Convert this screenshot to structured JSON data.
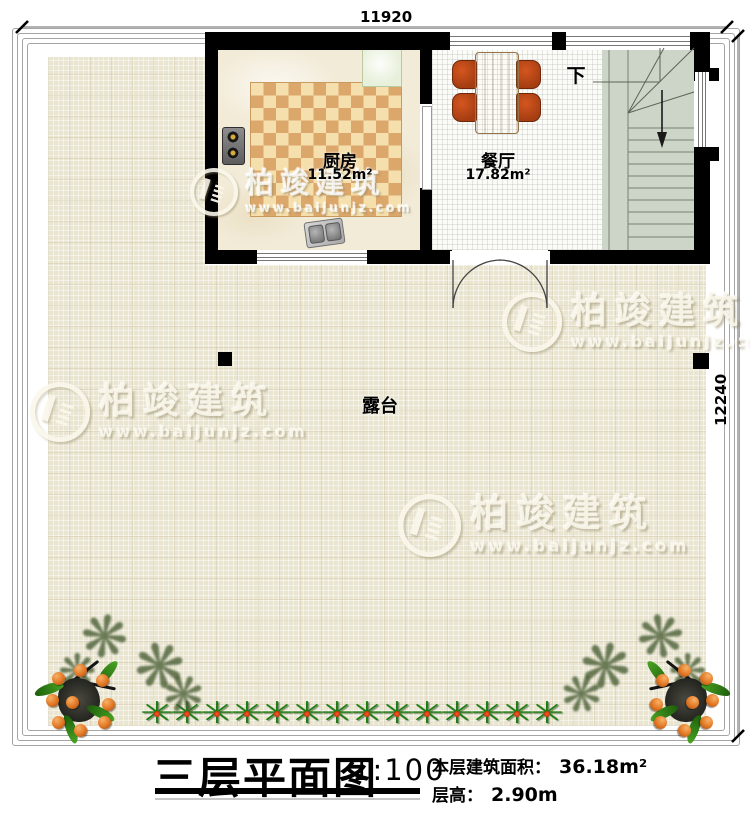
{
  "dimensions": {
    "width_label": "11920",
    "height_label": "12240"
  },
  "rooms": {
    "kitchen": {
      "name": "厨房",
      "area": "11.52m²"
    },
    "dining": {
      "name": "餐厅",
      "area": "17.82m²"
    },
    "terrace": {
      "name": "露台"
    },
    "stairs": {
      "direction_label": "下"
    }
  },
  "title_block": {
    "title": "三层平面图",
    "scale": "1:100",
    "area_label": "本层建筑面积：",
    "area_value": "36.18m²",
    "height_label": "层高：",
    "height_value": "2.90m"
  },
  "watermark": {
    "brand": "柏竣建筑",
    "url": "www.baijunjz.com"
  },
  "decorations": {
    "plant_row_count": 14
  },
  "colors": {
    "wall": "#000000",
    "terrace_floor": "#eae5d1",
    "stairs_floor": "#ccd5c8",
    "rug_orange": "#dba76b",
    "rug_cream": "#f5dfad",
    "chair": "#b0441a",
    "table": "#d4b088",
    "plant_green": "#1e7d12",
    "berry_orange": "#e07724"
  }
}
